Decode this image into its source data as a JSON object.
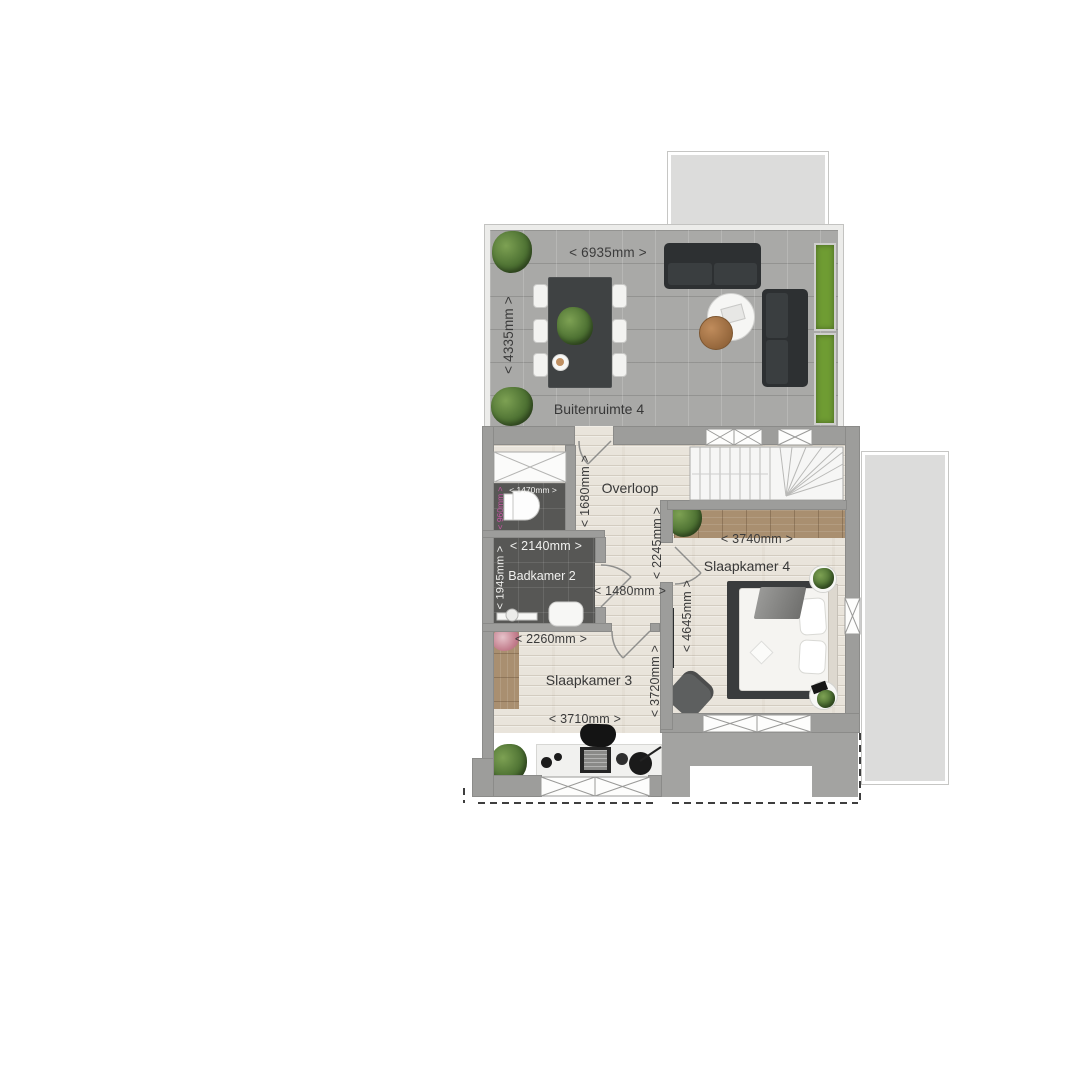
{
  "floorplan": {
    "terrace": {
      "name": "Buitenruimte 4",
      "width": "< 6935mm >",
      "depth": "< 4335mm >"
    },
    "toilet": {
      "width": "< 1470mm >",
      "depth": "< 960mm >"
    },
    "landing": {
      "name": "Overloop",
      "width": "< 1680mm >",
      "depth": "< 2245mm >"
    },
    "bathroom": {
      "name": "Badkamer 2",
      "width": "< 2140mm >",
      "depth": "< 1945mm >"
    },
    "hallway": {
      "width": "< 1480mm >"
    },
    "bedroom4": {
      "name": "Slaapkamer 4",
      "width": "< 3740mm >",
      "depth": "< 4645mm >"
    },
    "bedroom3": {
      "name": "Slaapkamer 3",
      "width_top": "< 2260mm >",
      "width_bottom": "< 3710mm >",
      "depth": "< 3720mm >"
    },
    "colors": {
      "wall": "#9d9d9b",
      "wood_floor": "#e9e4db",
      "terrace_tile": "#a9a9a7",
      "bath_tile": "#575755",
      "wardrobe_wood": "#a98f70",
      "planter_green": "#6f9c33",
      "dim_text": "#3b3b3b",
      "dim_accent": "#c855a5"
    }
  }
}
